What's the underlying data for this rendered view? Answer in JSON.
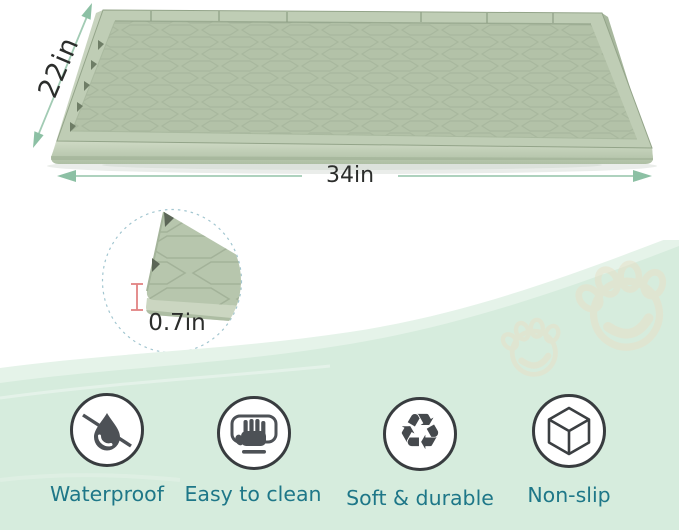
{
  "product_diagram": {
    "width_label": "34in",
    "depth_label": "22in",
    "thickness_label": "0.7in"
  },
  "features": {
    "items": [
      {
        "label": "Waterproof",
        "icon": "no-water-drop-icon"
      },
      {
        "label": "Easy to clean",
        "icon": "wiping-hand-icon"
      },
      {
        "label": "Soft & durable",
        "icon": "recycle-icon"
      },
      {
        "label": "Non-slip",
        "icon": "cube-icon"
      }
    ],
    "recycle_glyph": "♻"
  },
  "decorations": {
    "paw_prints": 2
  },
  "colors": {
    "mat_sage": "#b7c6ad",
    "mat_rim_light": "#c2cfb8",
    "wave_mint": "#d6ecdd",
    "wave_light": "#e5f3e9",
    "arrow_green": "#8cc0a4",
    "dimension_text": "#2b2d2b",
    "feature_text": "#1e7788",
    "icon_dark": "#4d5156",
    "measure_red": "#e28383",
    "paw_tan": "#e7e1c9",
    "detail_dash": "#a2c6d0"
  }
}
